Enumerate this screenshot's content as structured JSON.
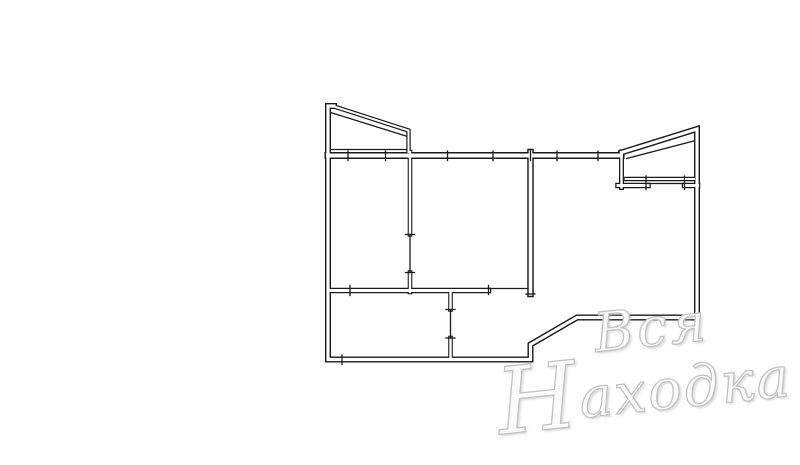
{
  "watermark": {
    "line1": "Вся",
    "line2_initial": "Н",
    "line2_rest": "аходка",
    "full_text": "Вся Находка",
    "color": "#c3c3c3"
  },
  "floor_plan": {
    "description": "apartment-floor-plan",
    "canvas": {
      "width": 800,
      "height": 465
    },
    "stroke_color": "#1a1a1a",
    "background_color": "#ffffff",
    "walls": [
      {
        "name": "outer-boundary",
        "d": "M 334 106 L 328 106 L 328 359.5 L 530.5 359.5 L 530.5 344.5 L 577 317.5 L 697 317.5 L 697 129 L 621.5 152.5",
        "w": 6,
        "g": 3.2
      },
      {
        "name": "main-top-wall",
        "d": "M 328 155.5 L 621 155.5",
        "w": 7,
        "g": 4
      },
      {
        "name": "balcony-left-outline",
        "d": "M 334 106.5 L 408.5 130.5 L 408.5 152",
        "w": 4.4,
        "g": 2
      },
      {
        "name": "balcony-right-connector",
        "d": "M 621.5 152 L 621.5 187.5",
        "w": 5,
        "g": 2.4
      },
      {
        "name": "right-room-top-wall-a",
        "d": "M 618 185.5 L 648 185.5",
        "w": 5.5,
        "g": 3
      },
      {
        "name": "right-room-top-wall-b",
        "d": "M 684.5 185.5 L 697.5 185.5",
        "w": 5.5,
        "g": 3
      },
      {
        "name": "balcony-right-floor",
        "d": "M 625.5 179 L 694 179",
        "w": 4.4,
        "g": 2
      },
      {
        "name": "partition-left-mid-upper",
        "d": "M 410 152 L 410 234.5",
        "w": 4.6,
        "g": 2.4
      },
      {
        "name": "partition-left-mid-lower",
        "d": "M 410 272.5 L 410 292",
        "w": 4.6,
        "g": 2.4
      },
      {
        "name": "partition-mid-right",
        "d": "M 530.5 152 L 530.5 294",
        "w": 6.5,
        "g": 3.6
      },
      {
        "name": "mid-bottom-wall",
        "d": "M 328 290.5 L 488.5 290.5",
        "w": 5.5,
        "g": 3
      },
      {
        "name": "kitchen-right-wall-upper",
        "d": "M 450.5 290.5 L 450.5 309.5",
        "w": 4.6,
        "g": 2.4
      },
      {
        "name": "kitchen-right-wall-lower",
        "d": "M 450.5 338 L 450.5 359.5",
        "w": 4.6,
        "g": 2.4
      }
    ],
    "thin_lines": [
      {
        "name": "balcony-left-inner-rail",
        "d": "M 330.5 112.5 L 406 136"
      },
      {
        "name": "balcony-left-floor-line",
        "d": "M 330.5 149.5 L 406.5 149.5"
      },
      {
        "name": "balcony-right-inner-rail",
        "d": "M 626.5 158.5 L 693.5 141"
      },
      {
        "name": "door-line-left-mid",
        "d": "M 410 234.5 L 410 272.5"
      },
      {
        "name": "door-line-kitchen",
        "d": "M 450.5 309.5 L 450.5 338"
      },
      {
        "name": "opening-line-mid-bottom",
        "d": "M 488.5 288.5 L 528 288.5"
      },
      {
        "name": "window-line-right-room",
        "d": "M 648 183.5 L 684.5 183.5"
      }
    ],
    "ticks": [
      {
        "name": "top-wall-tick-1",
        "d": "M 348 151 L 348 160.5"
      },
      {
        "name": "top-wall-tick-2",
        "d": "M 385.5 151 L 385.5 160.5"
      },
      {
        "name": "top-wall-tick-3",
        "d": "M 447.5 151 L 447.5 160.5"
      },
      {
        "name": "top-wall-tick-4",
        "d": "M 493 151 L 493 160.5"
      },
      {
        "name": "top-wall-tick-5",
        "d": "M 530.5 151 L 530.5 160.5"
      },
      {
        "name": "top-wall-tick-6",
        "d": "M 557 151 L 557 160.5"
      },
      {
        "name": "top-wall-tick-7",
        "d": "M 598 151 L 598 160.5"
      },
      {
        "name": "kitchen-top-wall-tick",
        "d": "M 350 285.5 L 350 295.5"
      },
      {
        "name": "bottom-wall-tick",
        "d": "M 342 355 L 342 364.5"
      },
      {
        "name": "door-jamb-left-mid-top",
        "d": "M 405.5 234.5 L 414.5 234.5"
      },
      {
        "name": "door-jamb-left-mid-bottom",
        "d": "M 405.5 272.5 L 414.5 272.5"
      },
      {
        "name": "door-jamb-kitchen-top",
        "d": "M 446 309.5 L 455 309.5"
      },
      {
        "name": "door-jamb-kitchen-bottom",
        "d": "M 446 338 L 455 338"
      },
      {
        "name": "partition-mid-right-endcap",
        "d": "M 526 294 L 535 294"
      },
      {
        "name": "opening-jamb-mid-bottom",
        "d": "M 488.5 285.5 L 488.5 294.5"
      },
      {
        "name": "window-jamb-right-room-a",
        "d": "M 646 176 L 646 189.5"
      },
      {
        "name": "window-jamb-right-room-b",
        "d": "M 684.5 176 L 684.5 189.5"
      }
    ]
  }
}
